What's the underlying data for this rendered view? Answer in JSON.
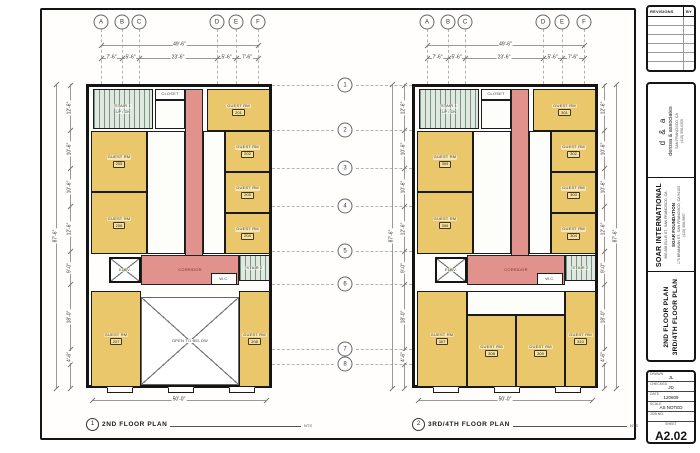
{
  "sheet": {
    "revisions": {
      "header": "REVISIONS",
      "by": "BY"
    },
    "firm": {
      "logo": "d & a",
      "name": "derosa & associates",
      "contact1": "SAN FRANCISCO, CA",
      "contact2": "(415) 398-0305"
    },
    "project": {
      "name": "SOAR INTERNATIONAL",
      "address": "860-868 ELLIS ST., SAN FRANCISCO, CA",
      "client": "SOAR FOUNDATION",
      "client_addr": "170 BRANNAN ST., SAN FRANCISCO, CA 94103",
      "client_phone": "(415) 358-9897"
    },
    "sheet_title": {
      "line1": "2ND FLOOR PLAN",
      "line2": "3RD/4TH FLOOR PLAN"
    },
    "block": {
      "drawn_label": "DRAWN",
      "drawn": "JL",
      "checked_label": "CHECKED",
      "checked": "JD",
      "date_label": "DATE",
      "date": "120609",
      "scale_label": "SCALE",
      "scale": "AS NOTED",
      "job_label": "JOB NO.",
      "job": "",
      "sheet_label": "SHEET",
      "number": "A2.02",
      "of": "OF SHEETS"
    }
  },
  "drawing": {
    "grid_cols": [
      {
        "label": "A",
        "x": 15
      },
      {
        "label": "B",
        "x": 36
      },
      {
        "label": "C",
        "x": 53
      },
      {
        "label": "D",
        "x": 131
      },
      {
        "label": "E",
        "x": 150
      },
      {
        "label": "F",
        "x": 172
      }
    ],
    "grid_rows": [
      {
        "label": "1",
        "y": 1
      },
      {
        "label": "2",
        "y": 46
      },
      {
        "label": "3",
        "y": 84
      },
      {
        "label": "4",
        "y": 122
      },
      {
        "label": "5",
        "y": 167
      },
      {
        "label": "6",
        "y": 200
      },
      {
        "label": "7",
        "y": 265
      },
      {
        "label": "8",
        "y": 280
      }
    ],
    "dims": {
      "top_overall": "49'-6\"",
      "top_segments": [
        "7'-6\"",
        "5'-6\"",
        "23'-6\"",
        "5'-6\"",
        "7'-6\""
      ],
      "side_overall": "87'-6\"",
      "side_segments": [
        "12'-6\"",
        "10'-6\"",
        "10'-6\"",
        "12'-6\"",
        "9'-0\"",
        "18'-0\"",
        "4'-6\""
      ],
      "bottom_overall": "50'-0\""
    },
    "plans": [
      {
        "id": "plan-2nd-floor",
        "caption_number": "1",
        "caption": "2ND FLOOR PLAN",
        "scale_note": "NTS",
        "origin": [
          86,
          84
        ],
        "rooms": [
          {
            "name": "stair-1",
            "type": "stair",
            "rect": [
              4,
              2,
              60,
              40
            ],
            "label": "STAIR 1",
            "sub": "UP / DN"
          },
          {
            "name": "closet",
            "type": "bath",
            "rect": [
              66,
              2,
              30,
              11
            ],
            "label": "CLOSET"
          },
          {
            "name": "bath-top",
            "type": "bath",
            "rect": [
              66,
              13,
              30,
              29
            ]
          },
          {
            "name": "corridor",
            "type": "corridor",
            "rect": [
              96,
              2,
              18,
              196
            ]
          },
          {
            "name": "corridor-hall",
            "type": "corridor",
            "rect": [
              52,
              168,
              98,
              30
            ],
            "label": "CORRIDOR"
          },
          {
            "name": "guest-rm-201",
            "type": "guest",
            "rect": [
              118,
              2,
              63,
              42
            ],
            "label": "GUEST RM",
            "num": "201"
          },
          {
            "name": "bath-right",
            "type": "bath",
            "rect": [
              114,
              44,
              22,
              123
            ]
          },
          {
            "name": "guest-rm-202",
            "type": "guest",
            "rect": [
              136,
              44,
              45,
              41
            ],
            "label": "GUEST RM",
            "num": "202"
          },
          {
            "name": "guest-rm-203",
            "type": "guest",
            "rect": [
              136,
              85,
              45,
              41
            ],
            "label": "GUEST RM",
            "num": "203"
          },
          {
            "name": "guest-rm-204",
            "type": "guest",
            "rect": [
              136,
              126,
              45,
              41
            ],
            "label": "GUEST RM",
            "num": "204"
          },
          {
            "name": "bath-left",
            "type": "bath",
            "rect": [
              58,
              44,
              38,
              123
            ]
          },
          {
            "name": "guest-rm-205",
            "type": "guest",
            "rect": [
              2,
              44,
              56,
              61
            ],
            "label": "GUEST RM",
            "num": "205"
          },
          {
            "name": "guest-rm-206",
            "type": "guest",
            "rect": [
              2,
              105,
              56,
              62
            ],
            "label": "GUEST RM",
            "num": "206"
          },
          {
            "name": "elevator",
            "type": "elevator xbox",
            "rect": [
              20,
              170,
              32,
              26
            ],
            "label": "ELEV."
          },
          {
            "name": "stair-2",
            "type": "stair",
            "rect": [
              150,
              168,
              31,
              26
            ],
            "label": "STAIR 2"
          },
          {
            "name": "wc",
            "type": "bath",
            "rect": [
              122,
              186,
              26,
              12
            ],
            "label": "W.C."
          },
          {
            "name": "guest-rm-207",
            "type": "guest",
            "rect": [
              2,
              204,
              50,
              96
            ],
            "label": "GUEST RM",
            "num": "207"
          },
          {
            "name": "guest-rm-208",
            "type": "guest",
            "rect": [
              150,
              204,
              31,
              96
            ],
            "label": "GUEST RM",
            "num": "208"
          },
          {
            "name": "open-to-below",
            "type": "open xbox",
            "rect": [
              52,
              210,
              98,
              88
            ],
            "label": "OPEN TO BELOW"
          }
        ]
      },
      {
        "id": "plan-3rd-4th-floor",
        "caption_number": "2",
        "caption": "3RD/4TH FLOOR PLAN",
        "scale_note": "NTS",
        "origin": [
          412,
          84
        ],
        "rooms": [
          {
            "name": "stair-1",
            "type": "stair",
            "rect": [
              4,
              2,
              60,
              40
            ],
            "label": "STAIR 1",
            "sub": "UP / DN"
          },
          {
            "name": "closet",
            "type": "bath",
            "rect": [
              66,
              2,
              30,
              11
            ],
            "label": "CLOSET"
          },
          {
            "name": "bath-top",
            "type": "bath",
            "rect": [
              66,
              13,
              30,
              29
            ]
          },
          {
            "name": "corridor",
            "type": "corridor",
            "rect": [
              96,
              2,
              18,
              196
            ]
          },
          {
            "name": "corridor-hall",
            "type": "corridor",
            "rect": [
              52,
              168,
              98,
              30
            ],
            "label": "CORRIDOR"
          },
          {
            "name": "guest-rm-301",
            "type": "guest",
            "rect": [
              118,
              2,
              63,
              42
            ],
            "label": "GUEST RM",
            "num": "301"
          },
          {
            "name": "bath-right",
            "type": "bath",
            "rect": [
              114,
              44,
              22,
              123
            ]
          },
          {
            "name": "guest-rm-302",
            "type": "guest",
            "rect": [
              136,
              44,
              45,
              41
            ],
            "label": "GUEST RM",
            "num": "302"
          },
          {
            "name": "guest-rm-303",
            "type": "guest",
            "rect": [
              136,
              85,
              45,
              41
            ],
            "label": "GUEST RM",
            "num": "303"
          },
          {
            "name": "guest-rm-304",
            "type": "guest",
            "rect": [
              136,
              126,
              45,
              41
            ],
            "label": "GUEST RM",
            "num": "304"
          },
          {
            "name": "bath-left",
            "type": "bath",
            "rect": [
              58,
              44,
              38,
              123
            ]
          },
          {
            "name": "guest-rm-305",
            "type": "guest",
            "rect": [
              2,
              44,
              56,
              61
            ],
            "label": "GUEST RM",
            "num": "305"
          },
          {
            "name": "guest-rm-306",
            "type": "guest",
            "rect": [
              2,
              105,
              56,
              62
            ],
            "label": "GUEST RM",
            "num": "306"
          },
          {
            "name": "elevator",
            "type": "elevator xbox",
            "rect": [
              20,
              170,
              32,
              26
            ],
            "label": "ELEV."
          },
          {
            "name": "stair-2",
            "type": "stair",
            "rect": [
              150,
              168,
              31,
              26
            ],
            "label": "STAIR 2"
          },
          {
            "name": "wc",
            "type": "bath",
            "rect": [
              122,
              186,
              26,
              12
            ],
            "label": "W.C."
          },
          {
            "name": "guest-rm-307",
            "type": "guest",
            "rect": [
              2,
              204,
              50,
              96
            ],
            "label": "GUEST RM",
            "num": "307"
          },
          {
            "name": "bath-bottom",
            "type": "bath",
            "rect": [
              52,
              204,
              98,
              24
            ]
          },
          {
            "name": "guest-rm-308",
            "type": "guest",
            "rect": [
              52,
              228,
              49,
              72
            ],
            "label": "GUEST RM",
            "num": "308"
          },
          {
            "name": "guest-rm-309",
            "type": "guest",
            "rect": [
              101,
              228,
              49,
              72
            ],
            "label": "GUEST RM",
            "num": "309"
          },
          {
            "name": "guest-rm-310",
            "type": "guest",
            "rect": [
              150,
              204,
              31,
              96
            ],
            "label": "GUEST RM",
            "num": "310"
          }
        ]
      }
    ]
  }
}
